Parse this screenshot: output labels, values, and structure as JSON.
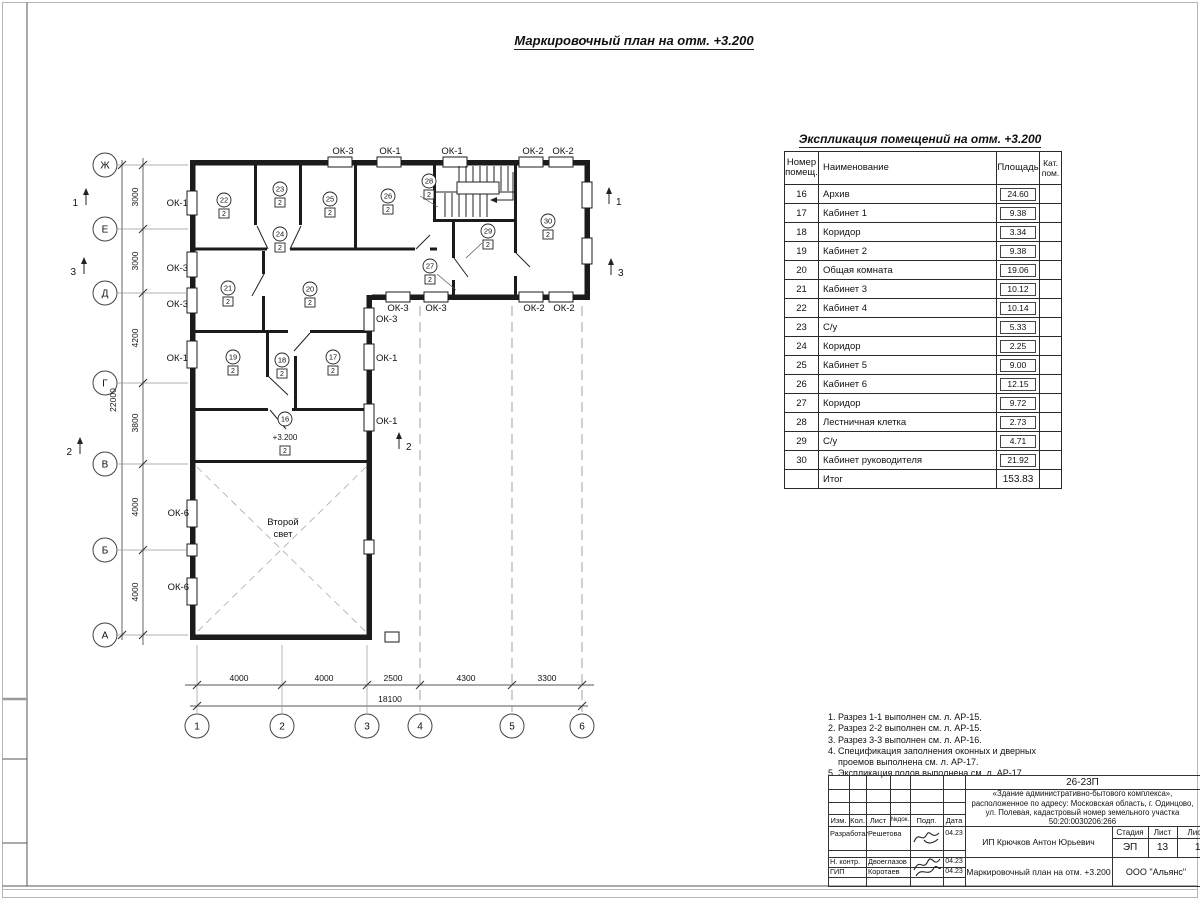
{
  "sheet": {
    "plan_title": "Маркировочный план на отм. +3.200",
    "expl_title": "Экспликация помещений на отм. +3.200"
  },
  "table": {
    "headers": {
      "num": "Номер\nпомещ.",
      "name": "Наименование",
      "area": "Площадь",
      "cat": "Кат.\nпом."
    },
    "rows": [
      [
        "16",
        "Архив",
        "24.60"
      ],
      [
        "17",
        "Кабинет 1",
        "9.38"
      ],
      [
        "18",
        "Коридор",
        "3.34"
      ],
      [
        "19",
        "Кабинет 2",
        "9.38"
      ],
      [
        "20",
        "Общая комната",
        "19.06"
      ],
      [
        "21",
        "Кабинет 3",
        "10.12"
      ],
      [
        "22",
        "Кабинет 4",
        "10.14"
      ],
      [
        "23",
        "С/у",
        "5.33"
      ],
      [
        "24",
        "Коридор",
        "2.25"
      ],
      [
        "25",
        "Кабинет 5",
        "9.00"
      ],
      [
        "26",
        "Кабинет 6",
        "12.15"
      ],
      [
        "27",
        "Коридор",
        "9.72"
      ],
      [
        "28",
        "Лестничная клетка",
        "2.73"
      ],
      [
        "29",
        "С/у",
        "4.71"
      ],
      [
        "30",
        "Кабинет руководителя",
        "21.92"
      ]
    ],
    "total_label": "Итог",
    "total_value": "153.83"
  },
  "notes": [
    {
      "text": "1. Разрез 1-1 выполнен см. л. АР-15.",
      "indent": false
    },
    {
      "text": "2. Разрез 2-2 выполнен см. л. АР-15.",
      "indent": false
    },
    {
      "text": "3. Разрез 3-3 выполнен см. л. АР-16.",
      "indent": false
    },
    {
      "text": "4. Спецификация заполнения оконных и дверных",
      "indent": false
    },
    {
      "text": "проемов выполнена см. л. АР-17.",
      "indent": true
    },
    {
      "text": "5. Экспликация полов выполнена см. л. АР-17.",
      "indent": false
    }
  ],
  "plan": {
    "axes_rows": [
      {
        "label": "Ж",
        "y": 165
      },
      {
        "label": "Е",
        "y": 229
      },
      {
        "label": "Д",
        "y": 293
      },
      {
        "label": "Г",
        "y": 383
      },
      {
        "label": "В",
        "y": 464
      },
      {
        "label": "Б",
        "y": 550
      },
      {
        "label": "А",
        "y": 635
      }
    ],
    "axes_cols": [
      {
        "label": "1",
        "x": 197,
        "leader": true
      },
      {
        "label": "2",
        "x": 282,
        "leader": true
      },
      {
        "label": "3",
        "x": 367,
        "leader": true
      },
      {
        "label": "4",
        "x": 420,
        "leader": false
      },
      {
        "label": "5",
        "x": 512,
        "leader": false
      },
      {
        "label": "6",
        "x": 582,
        "leader": false
      }
    ],
    "dims_v": [
      {
        "text": "3000",
        "y": 197
      },
      {
        "text": "3000",
        "y": 261
      },
      {
        "text": "4200",
        "y": 338
      },
      {
        "text": "3800",
        "y": 423
      },
      {
        "text": "4000",
        "y": 507
      },
      {
        "text": "4000",
        "y": 592
      }
    ],
    "dim_v_total": "22000",
    "dims_h": [
      {
        "text": "4000",
        "x": 239
      },
      {
        "text": "4000",
        "x": 324
      },
      {
        "text": "2500",
        "x": 393
      },
      {
        "text": "4300",
        "x": 466
      },
      {
        "text": "3300",
        "x": 547
      }
    ],
    "dim_h_total": "18100",
    "window_labels": [
      {
        "text": "ОК-1",
        "x": 188,
        "y": 206,
        "anchor": "end"
      },
      {
        "text": "ОК-3",
        "x": 188,
        "y": 271,
        "anchor": "end"
      },
      {
        "text": "ОК-3",
        "x": 188,
        "y": 307,
        "anchor": "end"
      },
      {
        "text": "ОК-1",
        "x": 188,
        "y": 361,
        "anchor": "end"
      },
      {
        "text": "ОК-6",
        "x": 189,
        "y": 516,
        "anchor": "end"
      },
      {
        "text": "ОК-6",
        "x": 189,
        "y": 590,
        "anchor": "end"
      },
      {
        "text": "ОК-3",
        "x": 343,
        "y": 154,
        "anchor": "middle"
      },
      {
        "text": "ОК-1",
        "x": 390,
        "y": 154,
        "anchor": "middle"
      },
      {
        "text": "ОК-1",
        "x": 452,
        "y": 154,
        "anchor": "middle"
      },
      {
        "text": "ОК-2",
        "x": 533,
        "y": 154,
        "anchor": "middle"
      },
      {
        "text": "ОК-2",
        "x": 563,
        "y": 154,
        "anchor": "middle"
      },
      {
        "text": "ОК-3",
        "x": 398,
        "y": 311,
        "anchor": "middle"
      },
      {
        "text": "ОК-3",
        "x": 436,
        "y": 311,
        "anchor": "middle"
      },
      {
        "text": "ОК-2",
        "x": 534,
        "y": 311,
        "anchor": "middle"
      },
      {
        "text": "ОК-2",
        "x": 564,
        "y": 311,
        "anchor": "middle"
      },
      {
        "text": "ОК-3",
        "x": 376,
        "y": 322,
        "anchor": "start"
      },
      {
        "text": "ОК-1",
        "x": 376,
        "y": 361,
        "anchor": "start"
      },
      {
        "text": "ОК-1",
        "x": 376,
        "y": 424,
        "anchor": "start"
      }
    ],
    "rooms": [
      {
        "num": "22",
        "x": 224,
        "y": 200
      },
      {
        "num": "23",
        "x": 280,
        "y": 189
      },
      {
        "num": "24",
        "x": 280,
        "y": 234
      },
      {
        "num": "25",
        "x": 330,
        "y": 199
      },
      {
        "num": "26",
        "x": 388,
        "y": 196
      },
      {
        "num": "28",
        "x": 429,
        "y": 181
      },
      {
        "num": "29",
        "x": 488,
        "y": 231
      },
      {
        "num": "30",
        "x": 548,
        "y": 221
      },
      {
        "num": "21",
        "x": 228,
        "y": 288
      },
      {
        "num": "20",
        "x": 310,
        "y": 289
      },
      {
        "num": "27",
        "x": 430,
        "y": 266
      },
      {
        "num": "19",
        "x": 233,
        "y": 357
      },
      {
        "num": "18",
        "x": 282,
        "y": 360
      },
      {
        "num": "17",
        "x": 333,
        "y": 357
      },
      {
        "num": "16",
        "x": 285,
        "y": 419,
        "elev": "+3.200"
      }
    ],
    "room_badge": "2",
    "section_markers": [
      {
        "label": "1",
        "x": 78,
        "y": 203,
        "side": "left"
      },
      {
        "label": "3",
        "x": 76,
        "y": 272,
        "side": "left"
      },
      {
        "label": "2",
        "x": 72,
        "y": 452,
        "side": "left"
      },
      {
        "label": "1",
        "x": 616,
        "y": 202,
        "side": "right"
      },
      {
        "label": "3",
        "x": 618,
        "y": 273,
        "side": "right"
      },
      {
        "label": "2",
        "x": 406,
        "y": 447,
        "side": "right"
      }
    ],
    "second_light": [
      "Второй",
      "свет"
    ]
  },
  "titleblock": {
    "code": "26-23П",
    "address": "«Здание административно-бытового комплекса», расположенное по адресу: Московская область, г. Одинцово, ул. Полевая, кадастровый номер земельного участка 50:20:0030206:266",
    "col_headers": [
      "Изм.",
      "Кол.",
      "Лист",
      "№док.",
      "Подп.",
      "Дата"
    ],
    "sign_rows": [
      {
        "role": "Разработал",
        "name": "Решетова",
        "date": "04.23"
      },
      {
        "role": "Н. контр.",
        "name": "Двоеглазов",
        "date": "04.23"
      },
      {
        "role": "ГИП",
        "name": "Коротаев",
        "date": "04.23"
      }
    ],
    "client": "ИП Крючков Антон Юрьевич",
    "stage_label": "Стадия",
    "sheet_label": "Лист",
    "sheets_label": "Листов",
    "stage": "ЭП",
    "sheet_no": "13",
    "sheets_total": "17",
    "doc_title": "Маркировочный план на отм. +3.200",
    "company": "ООО \"Альянс\""
  }
}
